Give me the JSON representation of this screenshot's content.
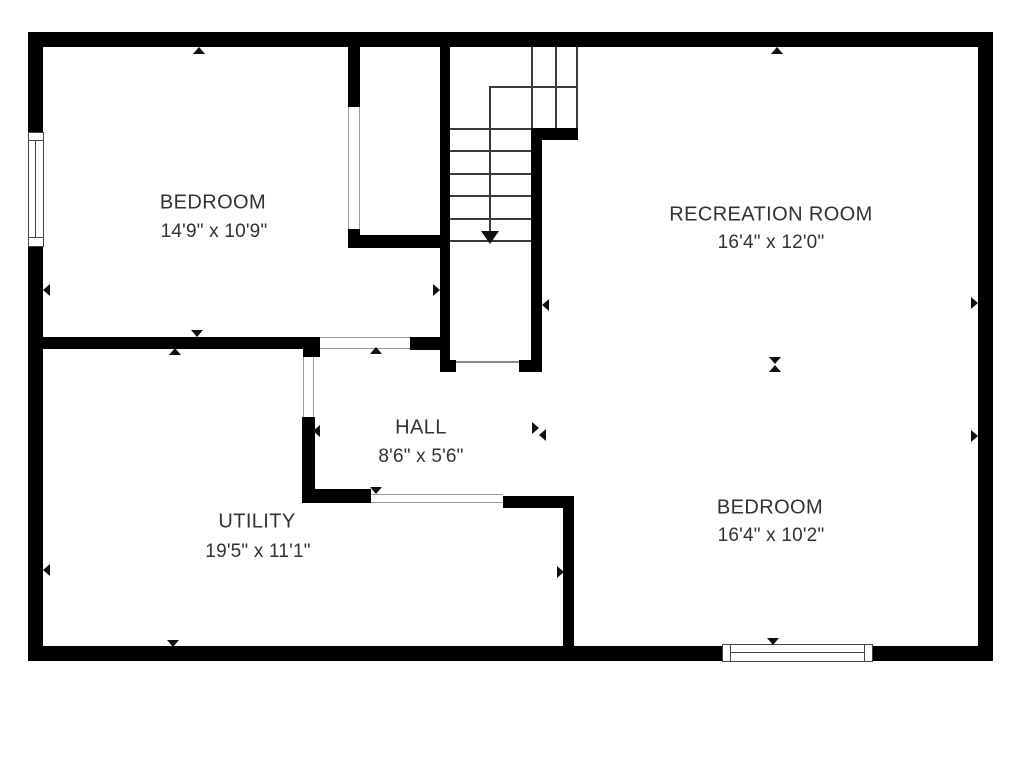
{
  "floor_plan": {
    "rooms": [
      {
        "id": "bedroom-1",
        "name": "BEDROOM",
        "dimensions": "14'9\" x 10'9\""
      },
      {
        "id": "recreation-room",
        "name": "RECREATION ROOM",
        "dimensions": "16'4\" x 12'0\""
      },
      {
        "id": "hall",
        "name": "HALL",
        "dimensions": "8'6\" x 5'6\""
      },
      {
        "id": "utility",
        "name": "UTILITY",
        "dimensions": "19'5\" x 11'1\""
      },
      {
        "id": "bedroom-2",
        "name": "BEDROOM",
        "dimensions": "16'4\" x 10'2\""
      }
    ],
    "stairs": {
      "shape": "u-shaped",
      "lower_tread_count": 6,
      "winder_count": 3,
      "direction_arrow": "down"
    },
    "windows": [
      {
        "wall": "left"
      },
      {
        "wall": "bottom"
      }
    ],
    "openings": [
      "bedroom-1-closet",
      "bedroom-1-to-hall",
      "hall-to-utility",
      "hall-to-stairs",
      "utility-doorway"
    ],
    "colors": {
      "wall": "#000000",
      "text": "#323232",
      "stair_line": "#3a3a3a",
      "opening_line": "#9a9a9a",
      "background": "#ffffff"
    }
  }
}
